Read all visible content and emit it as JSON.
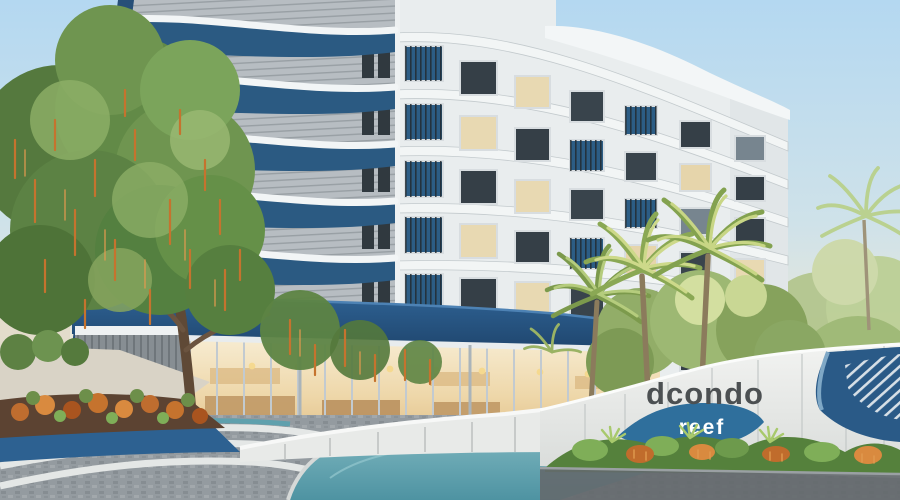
{
  "sign": {
    "brand": "dcondo",
    "sub": "reef",
    "brand_color": "#4c5052",
    "sub_color": "#ffffff",
    "wave_color": "#2f6f9c"
  },
  "palette": {
    "sky_top": "#b4d8f1",
    "sky_horizon": "#f2ecda",
    "building_navy": "#274f78",
    "balcony_wave_blue": "#2b5a82",
    "facade_white": "#e9edee",
    "siding_gray": "#b7bdc2",
    "window_dark": "#353f47",
    "window_lit": "#e8d9b2",
    "glass_warm": "#e9c98e",
    "teal_path": "#57a0ae",
    "paving_gray": "#949ba0",
    "foliage_green": "#6f9550",
    "flower_orange": "#c5732e",
    "lawn_green": "#5f9a3c",
    "sign_wall_white": "#eceeec"
  }
}
